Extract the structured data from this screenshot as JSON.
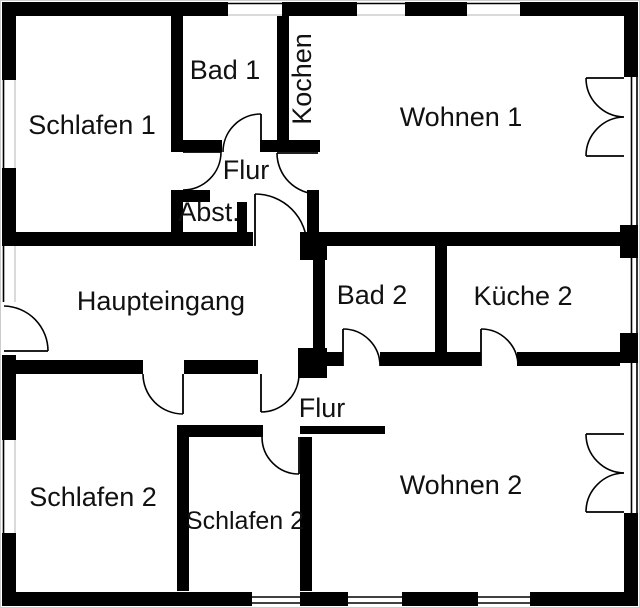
{
  "plan": {
    "type": "floor-plan",
    "colors": {
      "wall": "#000000",
      "background": "#ffffff",
      "label": "#111111",
      "window_sill": "#b4b4b4"
    },
    "rooms": [
      {
        "id": "schlafen-1",
        "label": "Schlafen 1"
      },
      {
        "id": "bad-1",
        "label": "Bad 1"
      },
      {
        "id": "kochen",
        "label": "Kochen"
      },
      {
        "id": "wohnen-1",
        "label": "Wohnen 1"
      },
      {
        "id": "flur-oben",
        "label": "Flur"
      },
      {
        "id": "abstellraum",
        "label": "Abst."
      },
      {
        "id": "haupteingang",
        "label": "Haupteingang"
      },
      {
        "id": "bad-2",
        "label": "Bad 2"
      },
      {
        "id": "kueche-2",
        "label": "Küche 2"
      },
      {
        "id": "flur-unten",
        "label": "Flur"
      },
      {
        "id": "schlafen-2-links",
        "label": "Schlafen 2"
      },
      {
        "id": "schlafen-2-mitte",
        "label": "Schlafen 2"
      },
      {
        "id": "wohnen-2",
        "label": "Wohnen 2"
      }
    ]
  }
}
